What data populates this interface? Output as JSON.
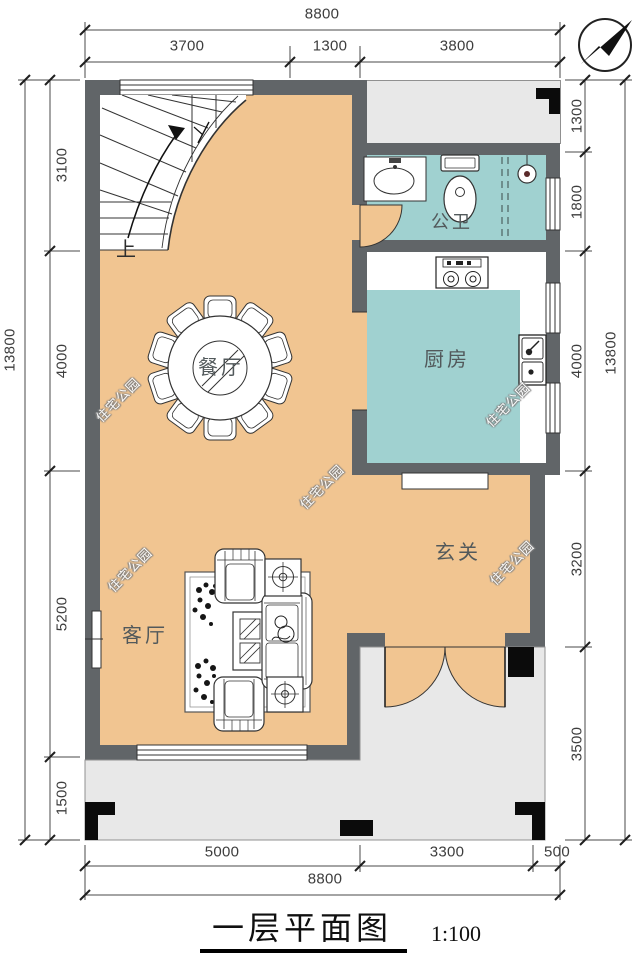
{
  "meta": {
    "title": "一层平面图",
    "scale": "1:100"
  },
  "watermark": "住宅公园",
  "rooms": {
    "dining": "餐厅",
    "kitchen": "厨房",
    "bathroom": "公卫",
    "living": "客厅",
    "foyer": "玄关",
    "stairs_up": "上"
  },
  "dimensions": {
    "top": {
      "total": "8800",
      "segments": [
        "3700",
        "1300",
        "3800"
      ]
    },
    "bottom": {
      "total": "8800",
      "segments": [
        "5000",
        "3300",
        "500"
      ]
    },
    "left": {
      "total": "13800",
      "segments": [
        "3100",
        "4000",
        "5200",
        "1500"
      ]
    },
    "right": {
      "total": "13800",
      "segments": [
        "1300",
        "1800",
        "4000",
        "3200",
        "3500"
      ]
    }
  },
  "colors": {
    "floor": "#F1C591",
    "wet_room": "#A0D1D0",
    "wall": "#616568",
    "outdoor": "#E8E8E8",
    "column": "#0B0B0B"
  }
}
